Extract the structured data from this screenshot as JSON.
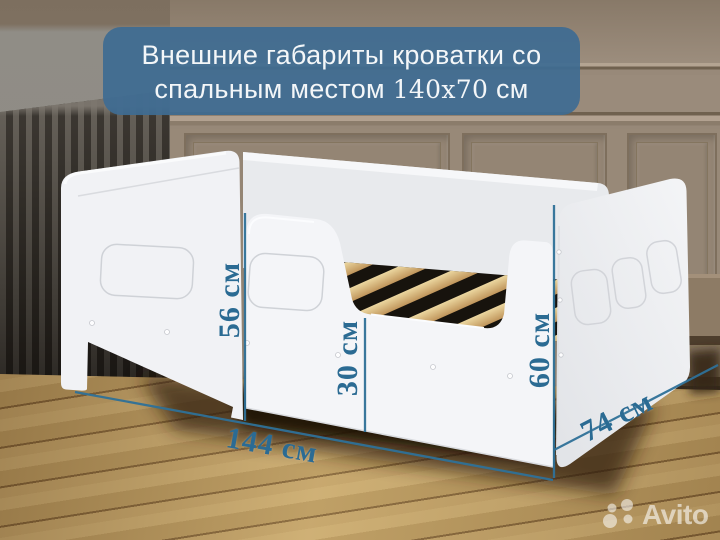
{
  "banner": {
    "line1": "Внешние габариты кроватки со",
    "line2_text": "спальным местом",
    "line2_dims": "140х70",
    "line2_unit": "см"
  },
  "dimensions": {
    "headboard_height": "56 см",
    "rail_height": "30 см",
    "footboard_height": "60 см",
    "length": "144 см",
    "width": "74 см"
  },
  "watermark": {
    "brand": "Avito"
  },
  "colors": {
    "dimension_accent": "#2b6b93",
    "dimension_line": "#2f7198",
    "banner_bg": "#3e6c92",
    "bed_white": "#f2f3f5",
    "wall_taupe": "#9a8b7b",
    "floor_wood": "#bf9f66"
  }
}
